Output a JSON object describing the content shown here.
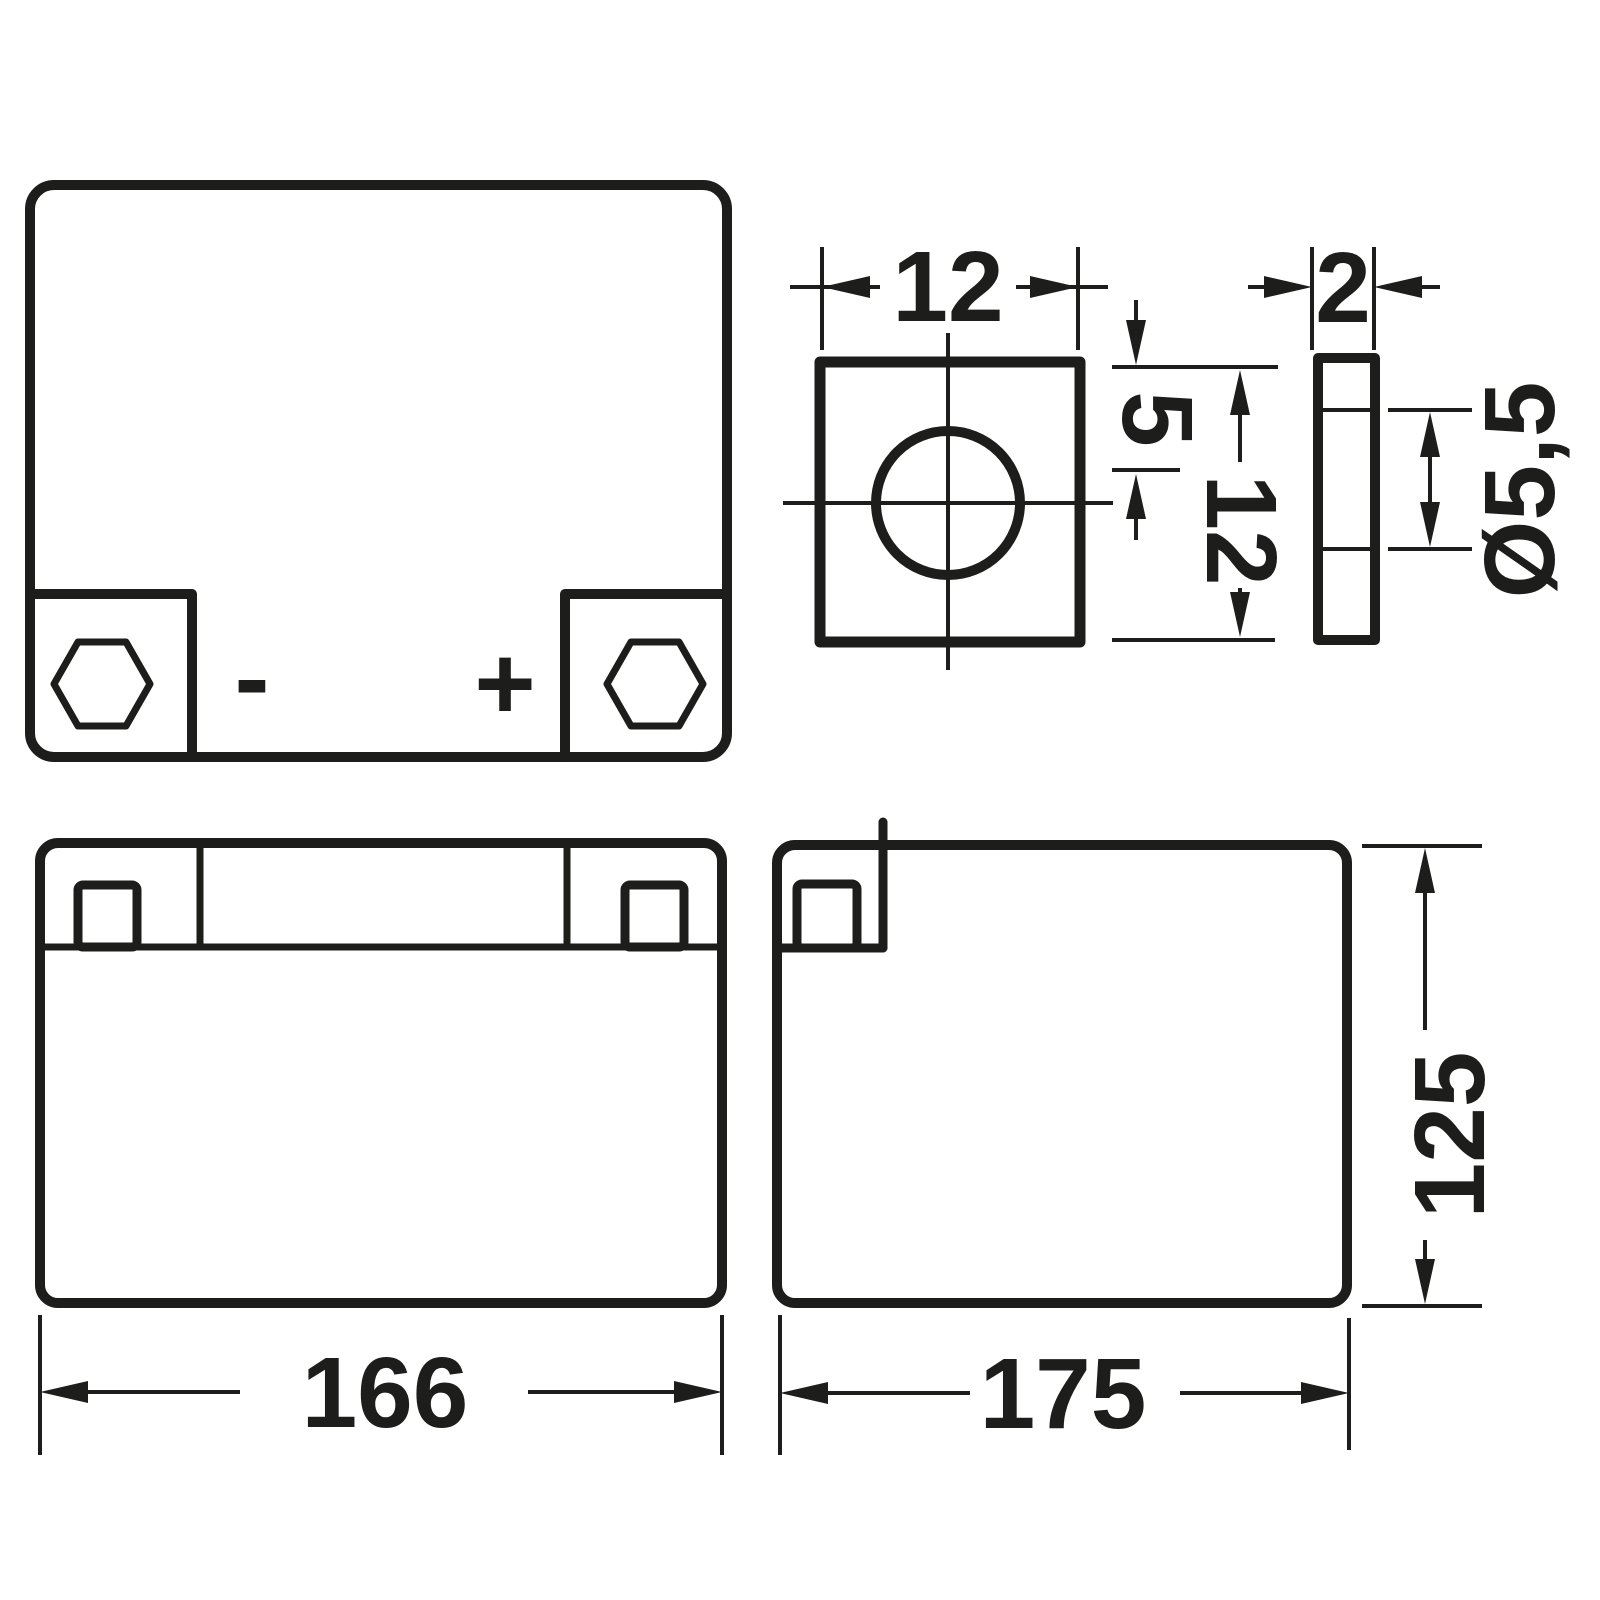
{
  "colors": {
    "line": "#1d1d1b",
    "background": "#ffffff"
  },
  "labels": {
    "terminal_width": "12",
    "hole_offset": "5",
    "terminal_height": "12",
    "plate_thickness": "2",
    "hole_diameter": "Ø5,5",
    "overall_length": "166",
    "overall_width": "175",
    "overall_height": "125",
    "negative_terminal": "-",
    "positive_terminal": "+"
  }
}
